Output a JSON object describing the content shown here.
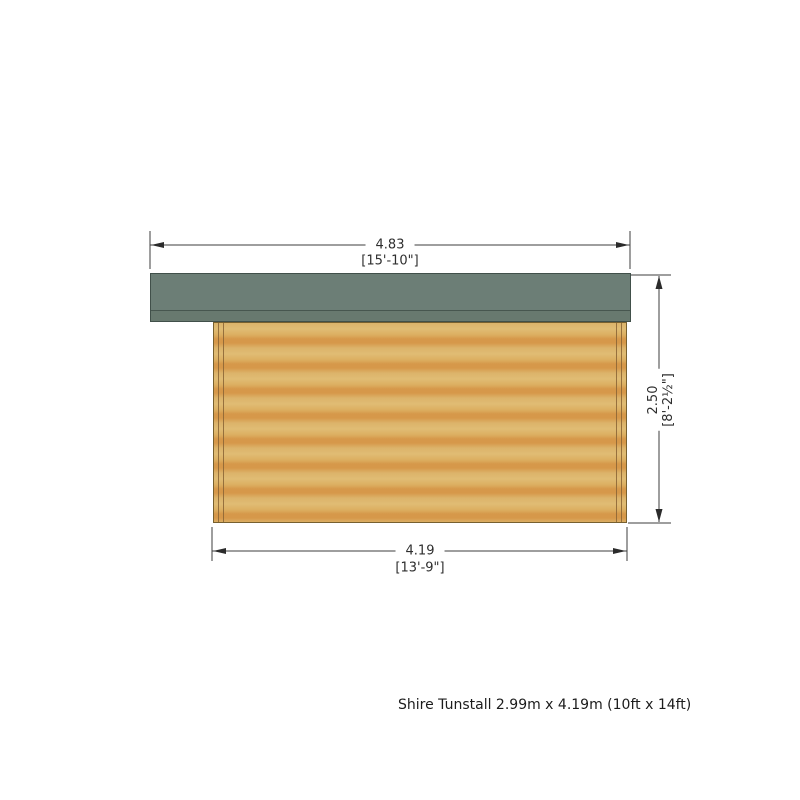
{
  "diagram": {
    "subject": "log cabin side elevation",
    "dimensions": {
      "top": {
        "metric": "4.83",
        "imperial": "[15'-10\"]"
      },
      "bottom": {
        "metric": "4.19",
        "imperial": "[13'-9\"]"
      },
      "right": {
        "metric": "2.50",
        "imperial": "[8'-2½\"]"
      }
    },
    "colors": {
      "roof": "#6c7e76",
      "roof_line": "#47564f",
      "wood_light": "#e0bc74",
      "wood_dark": "#d6984a",
      "dimension_line": "#3d3d3d",
      "background": "#ffffff"
    }
  },
  "caption": "Shire Tunstall 2.99m x 4.19m (10ft x 14ft)"
}
